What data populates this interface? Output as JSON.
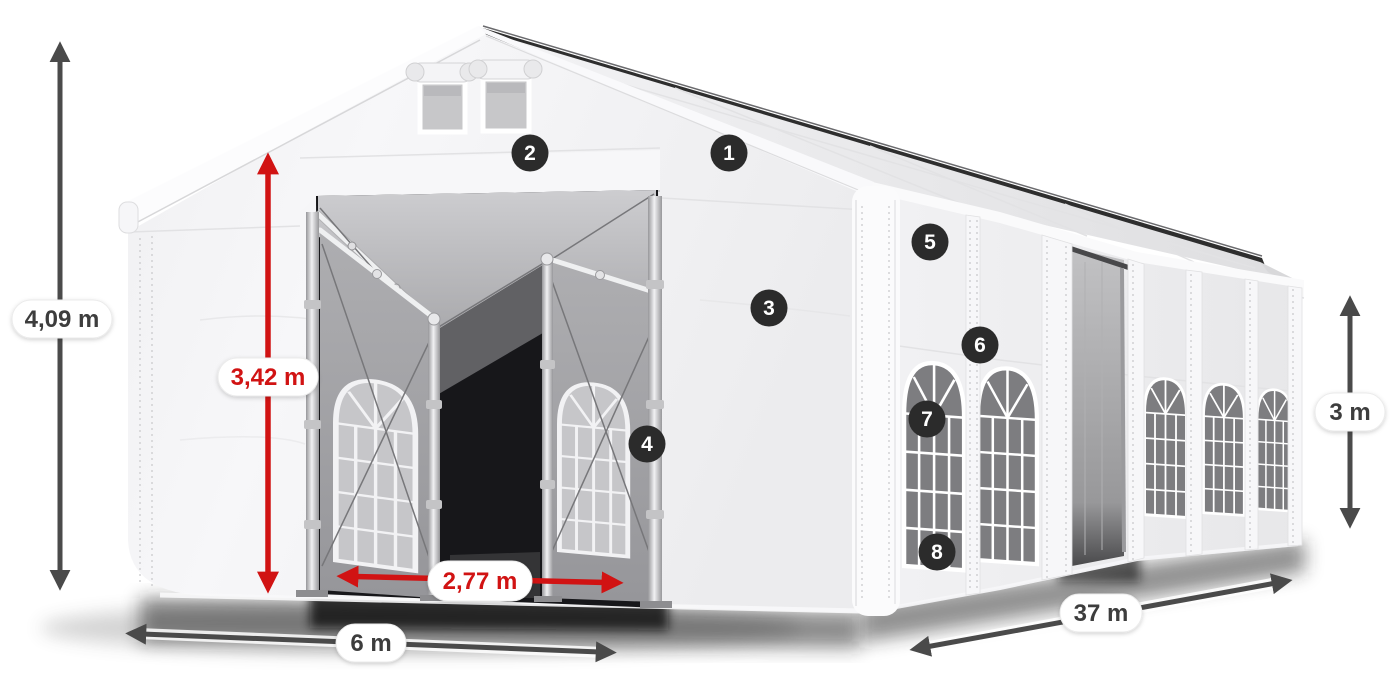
{
  "diagram": {
    "subject": "party-tent with entrance, dimension arrows and numbered feature markers"
  },
  "dimensions": {
    "total_height": "4,09 m",
    "entrance_height": "3,42 m",
    "entrance_width": "2,77 m",
    "width": "6 m",
    "length": "37 m",
    "side_wall_height": "3 m"
  },
  "badges": [
    "1",
    "2",
    "3",
    "4",
    "5",
    "6",
    "7",
    "8"
  ],
  "colors": {
    "dimension_red": "#d11313",
    "dimension_dark": "#4a4a4a",
    "badge_background": "#2b2b2b",
    "label_text": "#3d3d3d",
    "tent_fabric": "#f4f4f6",
    "window_glass": "#7d7d80",
    "background": "#ffffff"
  }
}
